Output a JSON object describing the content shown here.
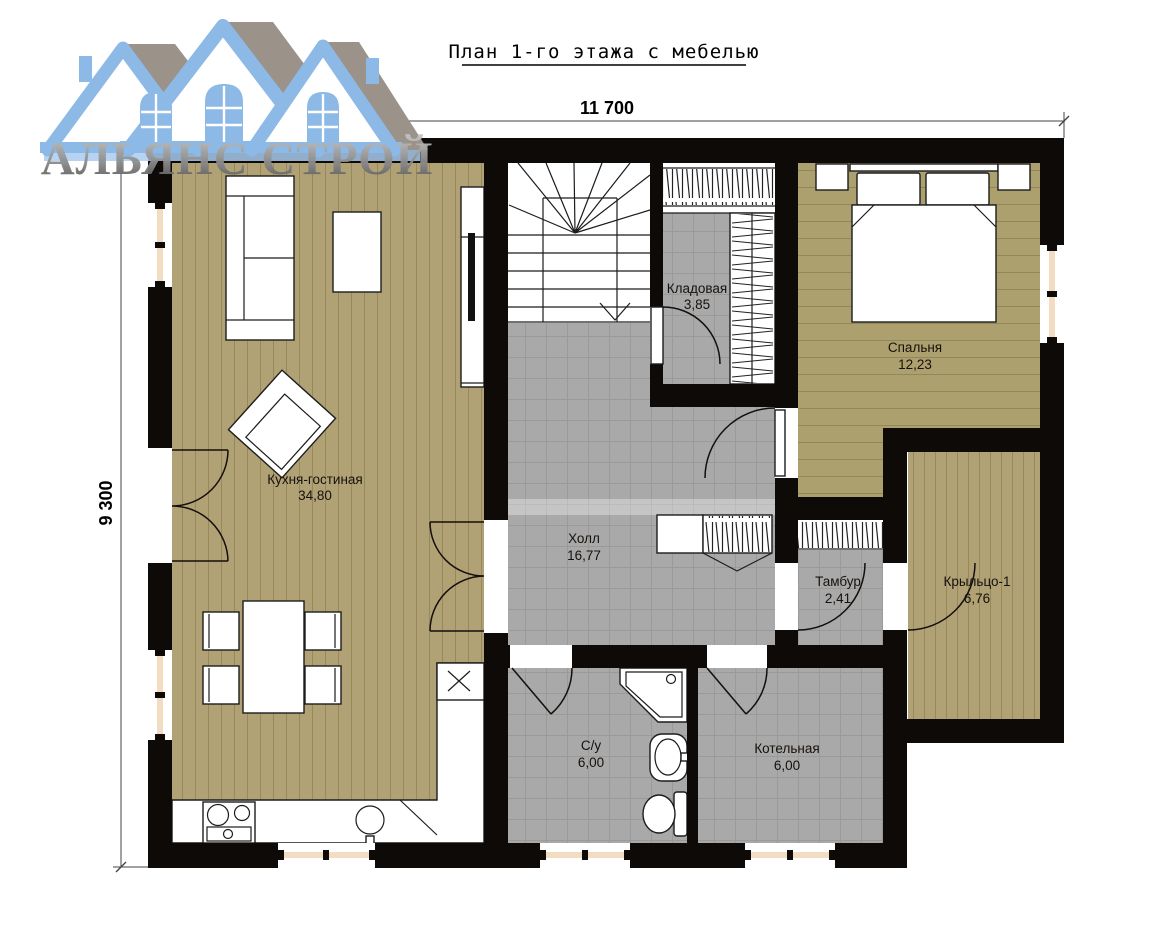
{
  "title": "План 1-го этажа с мебелью",
  "logo": {
    "company": "АЛЬЯНС СТРОЙ"
  },
  "dimensions": {
    "width": "11 700",
    "height": "9 300"
  },
  "rooms": {
    "kitchen_living": {
      "name": "Кухня-гостиная",
      "area": "34,80"
    },
    "storage": {
      "name": "Кладовая",
      "area": "3,85"
    },
    "bedroom": {
      "name": "Спальня",
      "area": "12,23"
    },
    "hall": {
      "name": "Холл",
      "area": "16,77"
    },
    "vestibule": {
      "name": "Тамбур",
      "area": "2,41"
    },
    "porch": {
      "name": "Крыльцо-1",
      "area": "6,76"
    },
    "bathroom": {
      "name": "С/у",
      "area": "6,00"
    },
    "boiler": {
      "name": "Котельная",
      "area": "6,00"
    }
  },
  "colors": {
    "wall": "#0d0a07",
    "wood_floor": "#b1a276",
    "tile_floor": "#a9a9a9",
    "window_frame": "#f2dcc2",
    "logo_blue": "#8cb9e6",
    "logo_gray": "#9b9289"
  }
}
